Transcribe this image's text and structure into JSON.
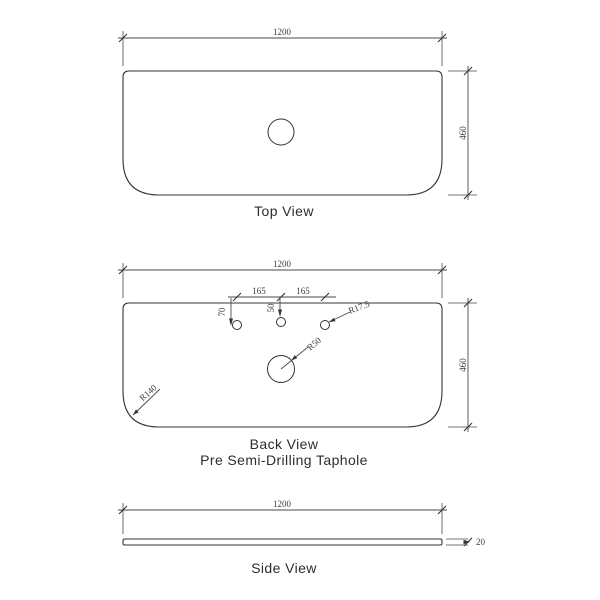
{
  "palette": {
    "line": "#343434",
    "dim": "#4a4a4a",
    "text": "#2d2d2d",
    "background": "#ffffff"
  },
  "views": {
    "top": {
      "label": "Top View",
      "dim_width": "1200",
      "dim_depth": "460"
    },
    "back": {
      "label": "Back View",
      "subtitle": "Pre Semi-Drilling Taphole",
      "dim_width": "1200",
      "dim_depth": "460",
      "dim_tap_spacing_left": "165",
      "dim_tap_spacing_right": "165",
      "dim_tap_offset_side": "70",
      "dim_tap_offset_center": "50",
      "dim_tap_radius": "R17.5",
      "dim_waste_radius": "R50",
      "dim_corner_radius": "R140"
    },
    "side": {
      "label": "Side View",
      "dim_width": "1200",
      "dim_thickness": "20"
    }
  }
}
